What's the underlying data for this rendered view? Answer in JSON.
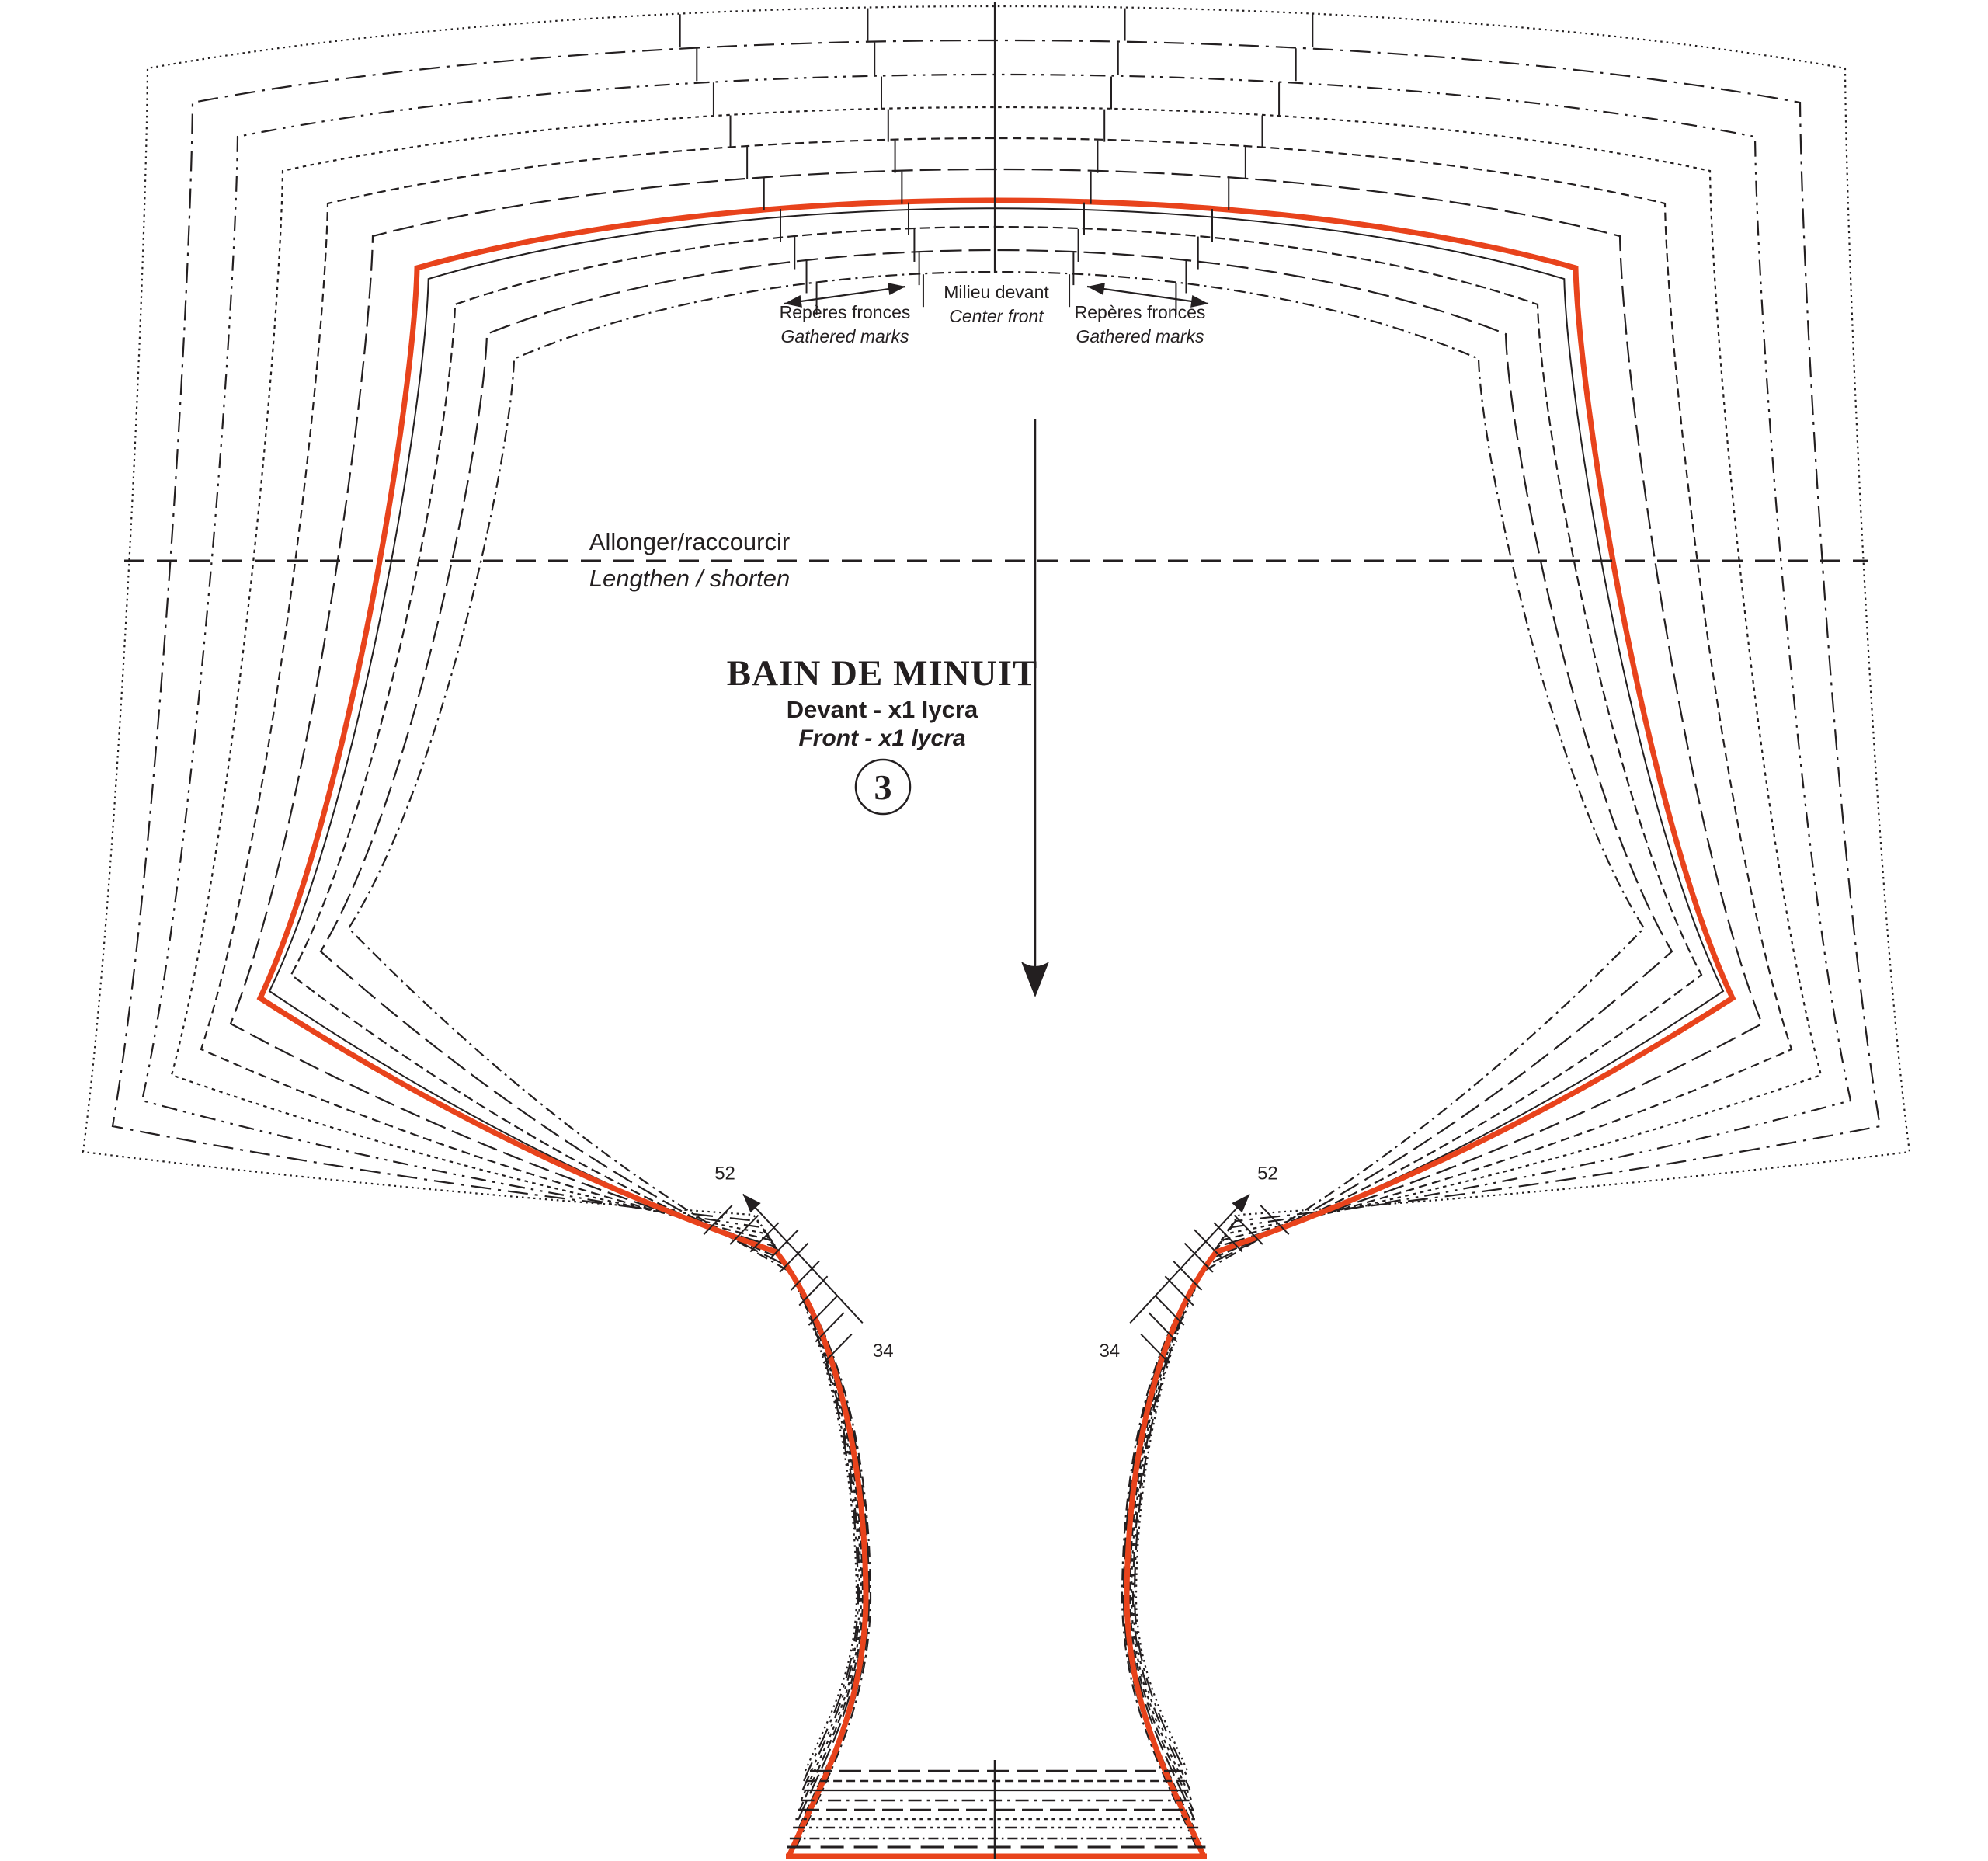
{
  "pattern": {
    "title": "BAIN DE MINUIT",
    "piece_fr": "Devant  - x1 lycra",
    "piece_en": "Front - x1 lycra",
    "piece_number": "3",
    "labels": {
      "center_front_fr": "Milieu devant",
      "center_front_en": "Center front",
      "gathers_fr": "Repères fronces",
      "gathers_en": "Gathered marks",
      "lengthen_fr": "Allonger/raccourcir",
      "lengthen_en": "Lengthen / shorten"
    },
    "size_ticks": {
      "max": "52",
      "min": "34"
    },
    "colors": {
      "highlight": "#e8431c",
      "ink": "#231f20"
    }
  }
}
